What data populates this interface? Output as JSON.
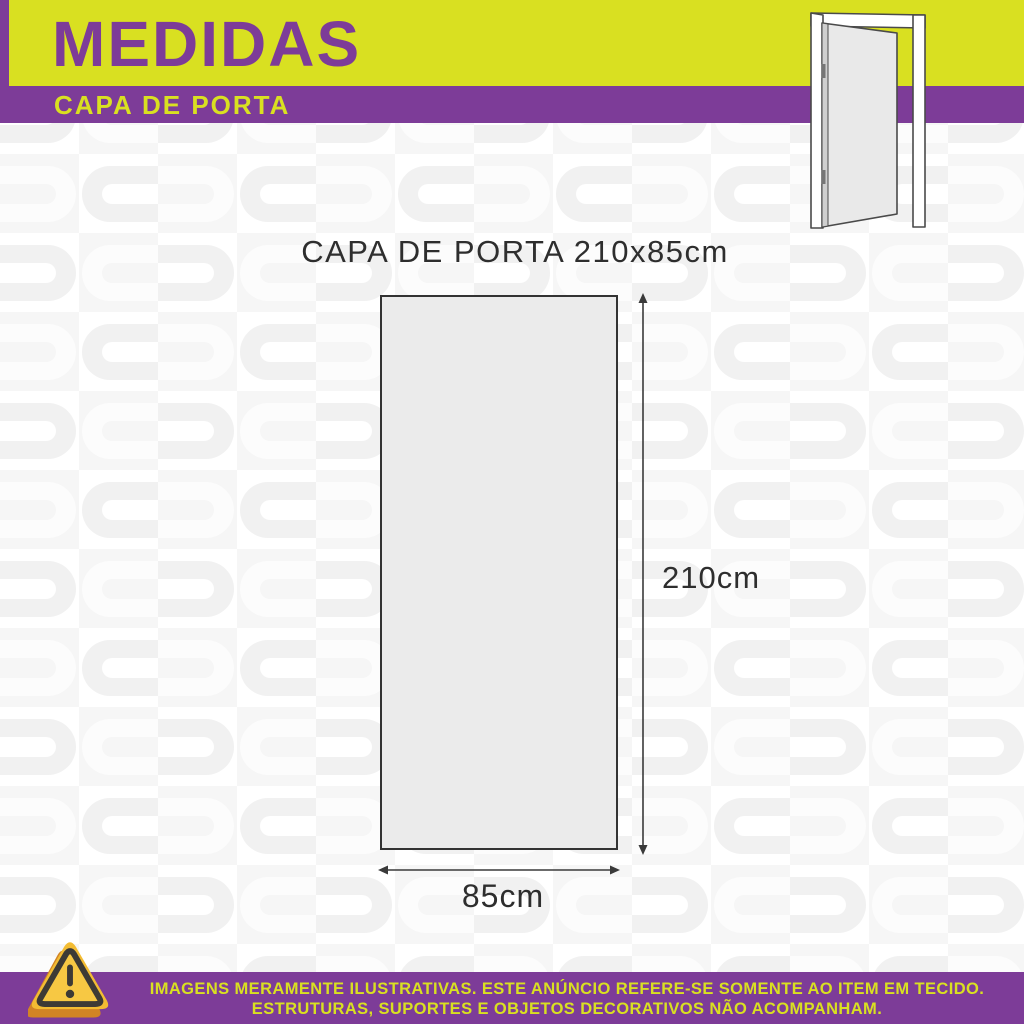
{
  "header": {
    "title": "MEDIDAS",
    "subtitle": "CAPA DE PORTA"
  },
  "hero": {
    "door_icon": "open-door-illustration"
  },
  "diagram": {
    "caption": "CAPA DE PORTA 210x85cm",
    "height_label": "210cm",
    "width_label": "85cm",
    "item_height_cm": 210,
    "item_width_cm": 85
  },
  "footer": {
    "warning_icon": "warning-triangle-icon",
    "line1": "IMAGENS MERAMENTE ILUSTRATIVAS. ESTE ANÚNCIO REFERE-SE SOMENTE AO ITEM EM TECIDO.",
    "line2": "ESTRUTURAS, SUPORTES E OBJETOS DECORATIVOS NÃO ACOMPANHAM."
  },
  "colors": {
    "lime": "#d9e021",
    "purple": "#7d3c98",
    "text_dark": "#2e2e2e",
    "panel_fill": "#ebebeb",
    "pattern_gray": "#f6f6f6",
    "warning_yellow": "#f7c843",
    "warning_orange": "#d28425"
  }
}
